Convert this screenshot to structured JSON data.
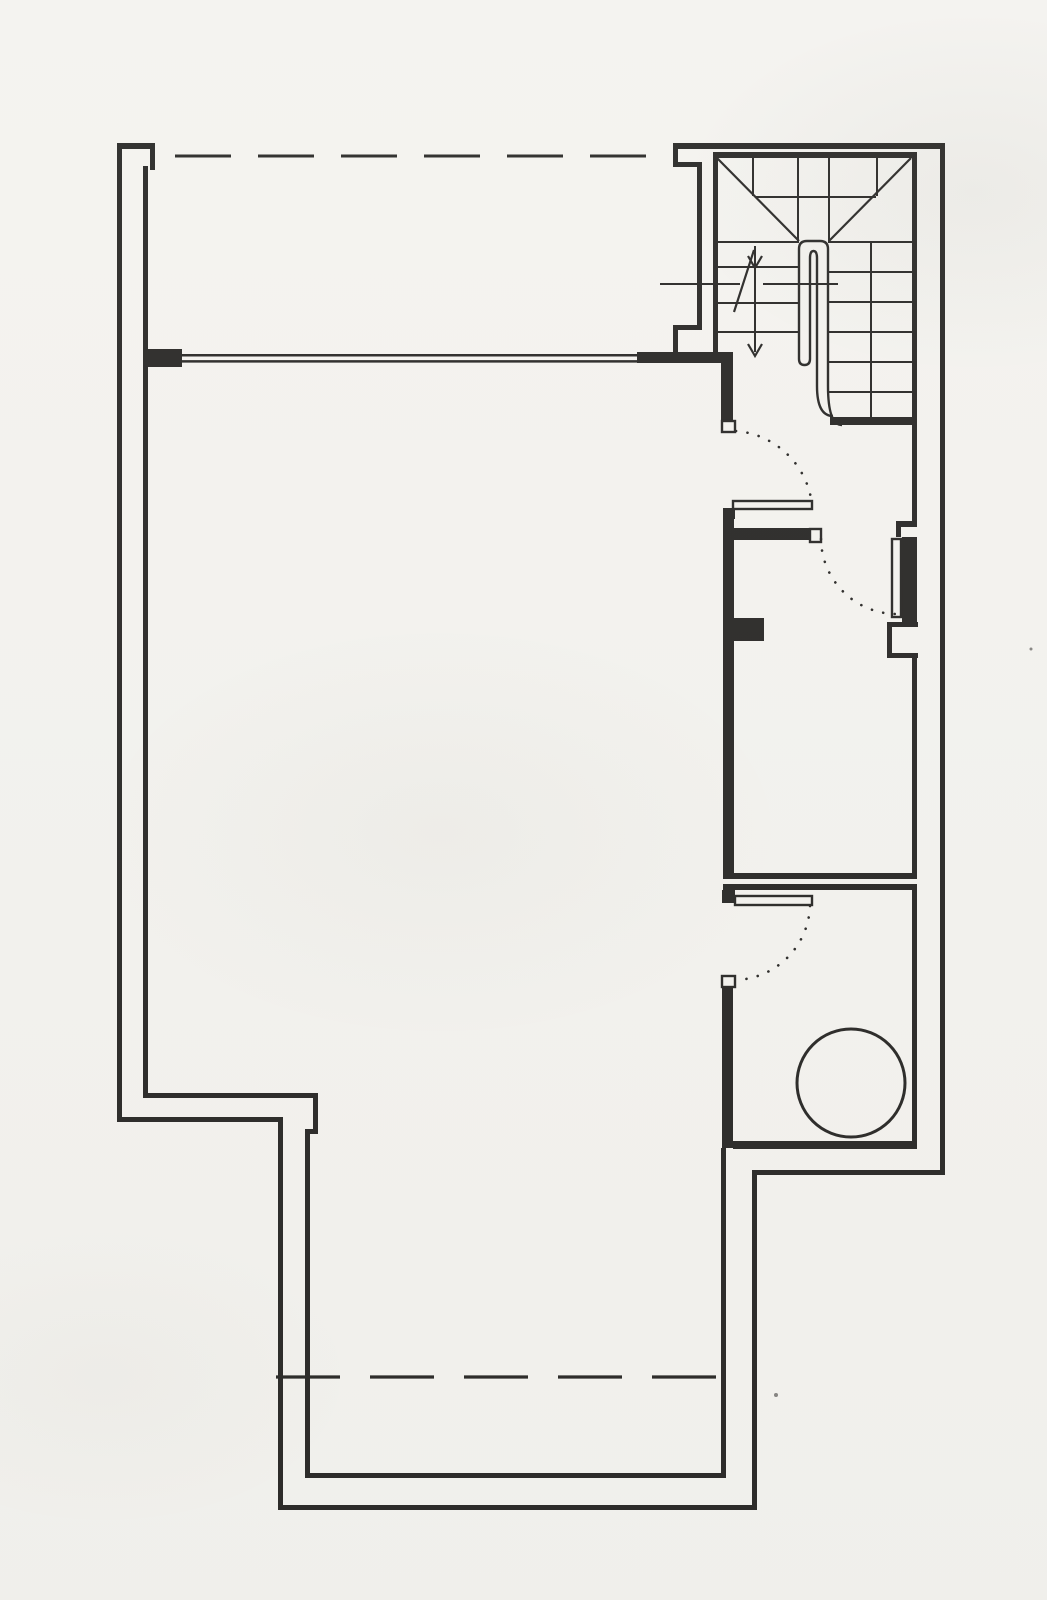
{
  "document": {
    "kind": "architectural floor plan scan",
    "page": {
      "width": 1047,
      "height": 1600
    },
    "background": "#f4f3ef",
    "ink": "#2d2c2a"
  },
  "floor_plan": {
    "wall_bars": [
      {
        "name": "exterior-wall-left-outer",
        "r": [
          117,
          143,
          5,
          979
        ]
      },
      {
        "name": "exterior-wall-left-step-outer",
        "r": [
          117,
          1117,
          166,
          5
        ]
      },
      {
        "name": "exterior-wall-lower-left-outer",
        "r": [
          278,
          1117,
          5,
          393
        ]
      },
      {
        "name": "exterior-wall-bottom-outer",
        "r": [
          278,
          1505,
          479,
          5
        ]
      },
      {
        "name": "exterior-wall-lower-right-outer",
        "r": [
          752,
          1170,
          5,
          340
        ]
      },
      {
        "name": "exterior-wall-step-outer",
        "r": [
          752,
          1170,
          193,
          5
        ]
      },
      {
        "name": "exterior-wall-right-outer",
        "r": [
          940,
          143,
          5,
          1032
        ]
      },
      {
        "name": "exterior-wall-top-outer",
        "r": [
          673,
          143,
          272,
          6
        ]
      },
      {
        "name": "exterior-wall-top-left-cap",
        "r": [
          117,
          143,
          38,
          6
        ]
      },
      {
        "name": "exterior-wall-cap-return",
        "r": [
          150,
          149,
          5,
          21
        ]
      },
      {
        "name": "exterior-wall-left-inner-upper",
        "r": [
          143,
          166,
          5,
          183
        ]
      },
      {
        "name": "window-pier-left",
        "r": [
          143,
          349,
          39,
          18
        ]
      },
      {
        "name": "exterior-wall-left-inner-lower",
        "r": [
          143,
          367,
          5,
          726
        ]
      },
      {
        "name": "left-step-inner-top",
        "r": [
          143,
          1093,
          175,
          5
        ]
      },
      {
        "name": "left-step-inner-vertical",
        "r": [
          313,
          1093,
          5,
          41
        ]
      },
      {
        "name": "left-step-inner-jog",
        "r": [
          305,
          1129,
          13,
          5
        ]
      },
      {
        "name": "exterior-wall-lower-left-inner",
        "r": [
          305,
          1129,
          5,
          349
        ]
      },
      {
        "name": "exterior-wall-bottom-inner",
        "r": [
          305,
          1473,
          421,
          5
        ]
      },
      {
        "name": "exterior-wall-lower-right-inner",
        "r": [
          721,
          1148,
          5,
          330
        ]
      },
      {
        "name": "utility-room-bottom-wall",
        "r": [
          733,
          1141,
          184,
          8
        ]
      },
      {
        "name": "exterior-wall-right-inner-upper",
        "r": [
          912,
          152,
          5,
          370
        ]
      },
      {
        "name": "exterior-wall-right-inner-mid",
        "r": [
          912,
          658,
          5,
          215
        ]
      },
      {
        "name": "exterior-wall-right-inner-lower",
        "r": [
          912,
          890,
          5,
          258
        ]
      },
      {
        "name": "stair-top-inner-wall",
        "r": [
          713,
          152,
          199,
          6
        ]
      },
      {
        "name": "stair-left-wall-outer-a",
        "r": [
          673,
          143,
          5,
          24
        ]
      },
      {
        "name": "stair-left-wall-jog-a",
        "r": [
          673,
          162,
          29,
          5
        ]
      },
      {
        "name": "stair-left-wall-outer-b",
        "r": [
          697,
          162,
          5,
          168
        ]
      },
      {
        "name": "stair-left-wall-jog-b",
        "r": [
          673,
          325,
          29,
          5
        ]
      },
      {
        "name": "stair-left-wall-outer-c",
        "r": [
          673,
          325,
          5,
          30
        ]
      },
      {
        "name": "stair-left-wall-inner",
        "r": [
          713,
          152,
          5,
          205
        ]
      },
      {
        "name": "lobby-wall-bar",
        "r": [
          637,
          352,
          96,
          11
        ]
      },
      {
        "name": "corridor-door-wall-above",
        "r": [
          721,
          361,
          12,
          61
        ]
      },
      {
        "name": "corridor-wall",
        "r": [
          723,
          512,
          11,
          362
        ]
      },
      {
        "name": "corridor-wall-pier",
        "r": [
          733,
          618,
          31,
          23
        ]
      },
      {
        "name": "middle-room-top-wall",
        "r": [
          723,
          528,
          88,
          12
        ]
      },
      {
        "name": "door-hinge-block-1",
        "r": [
          723,
          508,
          12,
          11
        ]
      },
      {
        "name": "middle-room-bottom-wall-a",
        "r": [
          723,
          873,
          194,
          6
        ]
      },
      {
        "name": "middle-room-bottom-wall-b",
        "r": [
          723,
          884,
          194,
          6
        ]
      },
      {
        "name": "right-door-frame",
        "r": [
          902,
          537,
          15,
          85
        ]
      },
      {
        "name": "right-door-jamb-jog-a",
        "r": [
          896,
          521,
          21,
          6
        ]
      },
      {
        "name": "right-door-jamb-jog-b",
        "r": [
          896,
          521,
          5,
          16
        ]
      },
      {
        "name": "right-wall-pier-top",
        "r": [
          887,
          622,
          31,
          5
        ]
      },
      {
        "name": "right-wall-pier-face",
        "r": [
          887,
          622,
          5,
          36
        ]
      },
      {
        "name": "right-wall-pier-bottom",
        "r": [
          887,
          653,
          31,
          5
        ]
      },
      {
        "name": "door-hinge-block-2",
        "r": [
          722,
          890,
          13,
          13
        ]
      },
      {
        "name": "utility-wall-stub",
        "r": [
          722,
          986,
          11,
          162
        ]
      },
      {
        "name": "understair-wall",
        "r": [
          830,
          417,
          87,
          8
        ]
      }
    ],
    "white_boxes": [
      {
        "name": "door-jamb-cap-1",
        "r": [
          722,
          421,
          13,
          11
        ]
      },
      {
        "name": "door-leaf-1",
        "r": [
          733,
          501,
          79,
          8
        ]
      },
      {
        "name": "door-jamb-cap-3",
        "r": [
          810,
          529,
          11,
          13
        ]
      },
      {
        "name": "door-leaf-3",
        "r": [
          892,
          539,
          9,
          78
        ]
      },
      {
        "name": "door-leaf-2",
        "r": [
          735,
          896,
          77,
          9
        ]
      },
      {
        "name": "door-jamb-cap-2",
        "r": [
          722,
          976,
          13,
          11
        ]
      }
    ],
    "thin_lines": [
      {
        "name": "balustrade-line-a",
        "l": [
          182,
          355.2,
          637,
          355.2,
          2.5
        ]
      },
      {
        "name": "balustrade-line-b",
        "l": [
          182,
          361.4,
          637,
          361.4,
          2.5
        ]
      },
      {
        "name": "winder-diagonal-left",
        "l": [
          717,
          158,
          799,
          241,
          2.2
        ]
      },
      {
        "name": "winder-diagonal-right",
        "l": [
          911,
          158,
          829,
          241,
          2.2
        ]
      },
      {
        "name": "winder-tread-a",
        "l": [
          753,
          158,
          753,
          196,
          2
        ]
      },
      {
        "name": "winder-tread-b",
        "l": [
          877,
          158,
          877,
          196,
          2
        ]
      },
      {
        "name": "winder-tread-c",
        "l": [
          755,
          197,
          876,
          197,
          2
        ]
      },
      {
        "name": "winder-tread-d",
        "l": [
          798,
          158,
          798,
          241,
          2
        ]
      },
      {
        "name": "winder-tread-e",
        "l": [
          829,
          158,
          829,
          241,
          2
        ]
      },
      {
        "name": "right-flight-tread-1",
        "l": [
          828,
          242,
          912,
          242,
          2
        ]
      },
      {
        "name": "right-flight-tread-2",
        "l": [
          828,
          272,
          912,
          272,
          2
        ]
      },
      {
        "name": "right-flight-tread-3",
        "l": [
          828,
          302,
          912,
          302,
          2
        ]
      },
      {
        "name": "right-flight-tread-4",
        "l": [
          828,
          332,
          912,
          332,
          2
        ]
      },
      {
        "name": "right-flight-tread-5",
        "l": [
          828,
          362,
          912,
          362,
          2
        ]
      },
      {
        "name": "right-flight-tread-6",
        "l": [
          828,
          392,
          912,
          392,
          2
        ]
      },
      {
        "name": "left-flight-tread-1",
        "l": [
          717,
          242,
          799,
          242,
          2
        ]
      },
      {
        "name": "left-flight-tread-2",
        "l": [
          717,
          267,
          799,
          267,
          2
        ]
      },
      {
        "name": "left-flight-tread-3",
        "l": [
          717,
          303,
          799,
          303,
          2
        ]
      },
      {
        "name": "left-flight-tread-4",
        "l": [
          717,
          332,
          799,
          332,
          2
        ]
      },
      {
        "name": "stair-walk-line",
        "l": [
          871,
          242,
          871,
          417,
          2
        ]
      }
    ],
    "guide_lines": [
      {
        "name": "stair-cut-line-left",
        "l": [
          660,
          284,
          740,
          284,
          2
        ]
      },
      {
        "name": "stair-cut-line-right",
        "l": [
          763,
          284,
          838,
          284,
          2
        ]
      },
      {
        "name": "stair-cut-break",
        "l": [
          754,
          250,
          734,
          312,
          2.2
        ]
      },
      {
        "name": "stair-direction-shaft",
        "l": [
          755,
          246,
          755,
          352,
          2
        ]
      }
    ],
    "arrowheads": [
      {
        "name": "stair-arrowhead-upper",
        "pts": "748,256 755,268 762,256"
      },
      {
        "name": "stair-arrowhead-lower",
        "pts": "748,344 755,356 762,344"
      }
    ],
    "dashed_lines": [
      {
        "name": "overhead-edge-top",
        "l": [
          175,
          156,
          671,
          156,
          3
        ],
        "dash": "56 27"
      },
      {
        "name": "overhead-edge-bottom",
        "l": [
          276,
          1377,
          731,
          1377,
          3.2
        ],
        "dash": "64 30"
      }
    ],
    "dotted_arcs": [
      {
        "name": "door-swing-arc-1",
        "d": "M736,431 A83,83 0 0 1 812,505"
      },
      {
        "name": "door-swing-arc-2",
        "d": "M810,906 A77,77 0 0 1 736,980"
      },
      {
        "name": "door-swing-arc-3",
        "d": "M821,539 A76,76 0 0 0 896,614"
      }
    ],
    "curves": [
      {
        "name": "stair-core-outer",
        "d": "M799,359 L799,249 Q799,241 807,241 L820,241 Q828,241 828,249 L828,386",
        "w": 2.4
      },
      {
        "name": "stair-core-inner",
        "d": "M810,359 L810,258 Q810,251 813.5,251 Q817,251 817,258 L817,386",
        "w": 2.4
      },
      {
        "name": "stair-core-left-tip",
        "d": "M799,359 Q799,365 804.5,365 Q810,365 810,359",
        "w": 2.4
      },
      {
        "name": "stair-core-elbow-inner",
        "d": "M817,386 Q817,416 833,416",
        "w": 2.4
      },
      {
        "name": "stair-core-elbow-outer",
        "d": "M828,386 Q828,425 842,425",
        "w": 2.4
      }
    ],
    "fixture_circle": {
      "name": "round-fixture",
      "cx": 851,
      "cy": 1083,
      "r": 54,
      "w": 3
    },
    "specks": [
      {
        "x": 776,
        "y": 1395,
        "r": 2
      },
      {
        "x": 1031,
        "y": 649,
        "r": 1.5
      }
    ]
  }
}
